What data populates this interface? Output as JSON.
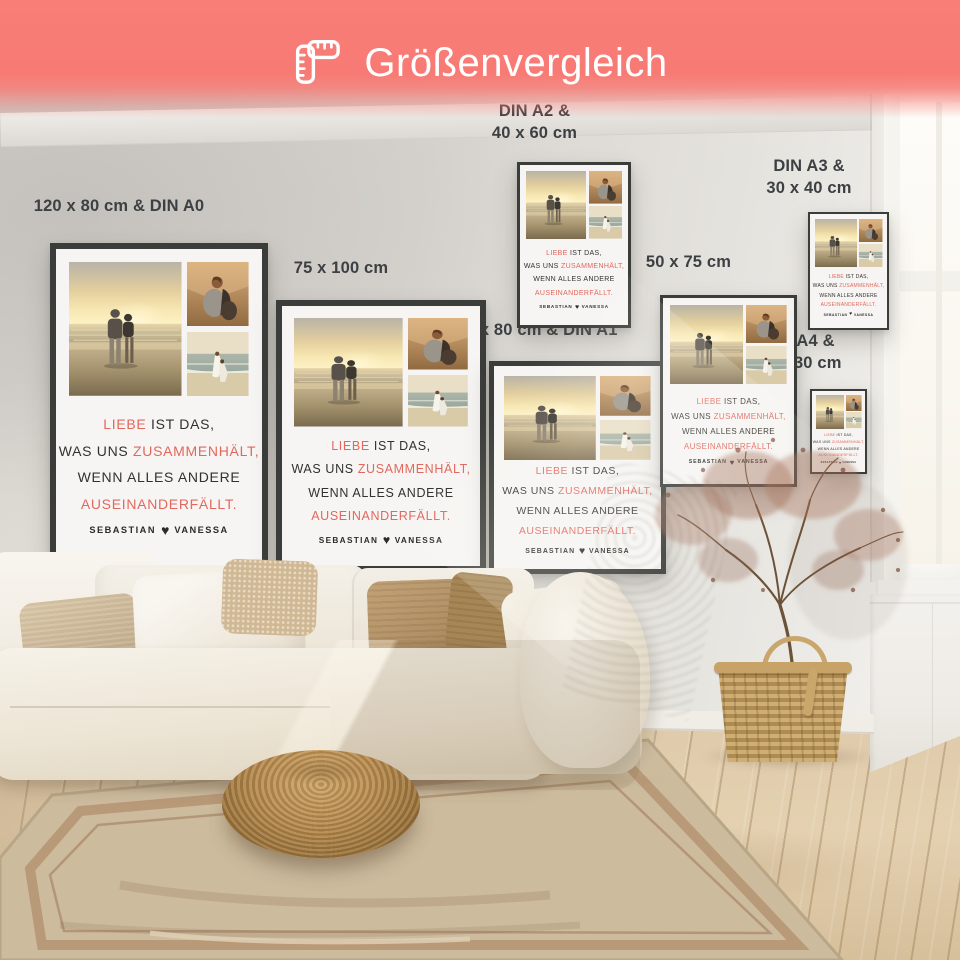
{
  "header": {
    "title": "Größenvergleich",
    "icon": "corner-ruler-icon",
    "background_color": "#f87a74",
    "text_color": "#ffffff"
  },
  "posters": {
    "accent_color": "#e2675d",
    "ink_color": "#33312e",
    "frame_color": "#3a3d3a",
    "quote": {
      "l1_accent": "LIEBE",
      "l1_rest": "IST DAS,",
      "l2_lead": "WAS UNS",
      "l2_accent": "ZUSAMMENHÄLT,",
      "l3": "WENN ALLES ANDERE",
      "l4_accent": "AUSEINANDERFÄLLT.",
      "name_left": "SEBASTIAN",
      "heart": "♥",
      "name_right": "VANESSA"
    },
    "items": [
      {
        "id": "din-a0",
        "label": "120 x 80 cm & DIN A0"
      },
      {
        "id": "75x100",
        "label": "75 x 100 cm"
      },
      {
        "id": "din-a2",
        "label": "DIN A2 &\n40 x 60 cm"
      },
      {
        "id": "din-a1",
        "label": "60 x 80 cm & DIN A1"
      },
      {
        "id": "50x75",
        "label": "50 x 75 cm"
      },
      {
        "id": "din-a3",
        "label": "DIN A3 &\n30 x 40 cm"
      },
      {
        "id": "din-a4",
        "label": "DIN A4 &\n20 x 30 cm"
      }
    ]
  },
  "scene": {
    "wall_color": "#d8d5d0",
    "floor_color": "#ddc9a9",
    "rug_color": "#cdbb9e",
    "sofa_color": "#f2eee6",
    "pouf_color": "#b98d52",
    "basket_color": "#c2a066",
    "label_text_color": "#3d4043"
  }
}
